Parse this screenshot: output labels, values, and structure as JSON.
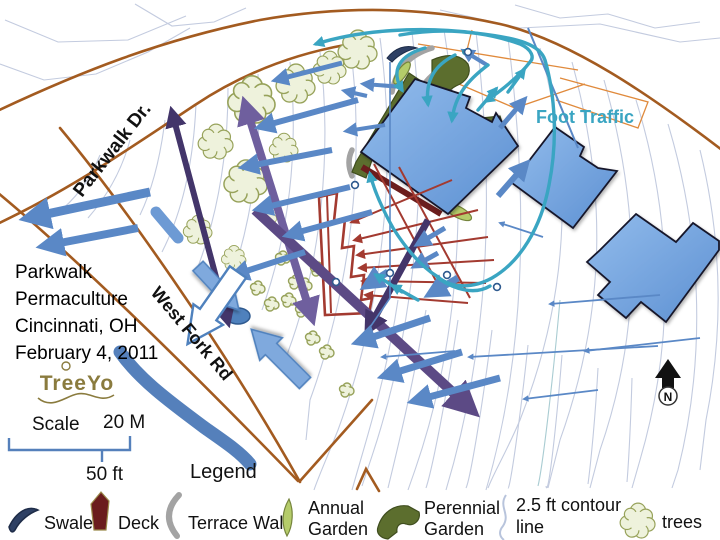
{
  "title_block": {
    "line1": "Parkwalk",
    "line2": "Permaculture",
    "line3": "Cincinnati, OH",
    "line4": "February 4, 2011"
  },
  "logo": {
    "text": "TreeYo"
  },
  "scale": {
    "label": "Scale",
    "metric": "20 M",
    "imperial": "50 ft"
  },
  "legend": {
    "title": "Legend",
    "swale": "Swale",
    "deck": "Deck",
    "terrace_wall": "Terrace Wall",
    "annual_line1": "Annual",
    "annual_line2": "Garden",
    "perennial_line1": "Perennial",
    "perennial_line2": "Garden",
    "contour_line1": "2.5 ft contour",
    "contour_line2": "line",
    "trees": "trees"
  },
  "map_labels": {
    "parkwalk_dr": "Parkwalk Dr.",
    "west_fork_rd": "West Fork Rd",
    "foot_traffic": "Foot Traffic",
    "north": "N"
  },
  "colors": {
    "boundary_brown": "#a35b20",
    "thin_orange": "#e08a3c",
    "contour_blue": "#c3cbdf",
    "water_blue": "#4f81bd",
    "building_blue": "#7fb0e4",
    "foot_traffic_teal": "#3aa5c2",
    "flow_arrow_blue": "#5a88c6",
    "purple_dark": "#43356a",
    "purple_medium": "#6f5f9e",
    "red_terrace": "#a33a30",
    "deck_maroon": "#6b1d1d",
    "perennial_green": "#5c6e2e",
    "annual_green": "#b5cc6a",
    "tree_fill": "#eef2dc",
    "tree_stroke": "#97a25a"
  }
}
